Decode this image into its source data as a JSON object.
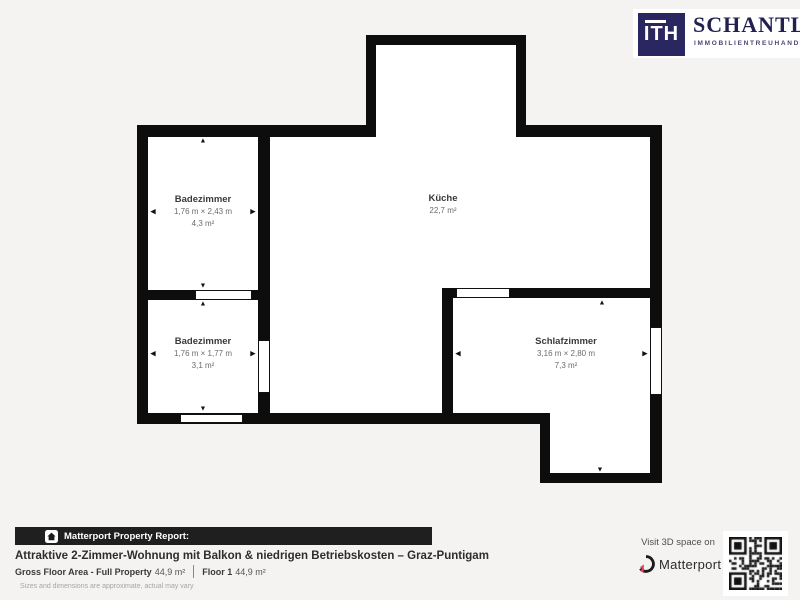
{
  "logo": {
    "monogram": "ITH",
    "brand": "SCHANTL",
    "tagline": "IMMOBILIENTREUHAND",
    "navy": "#2a265f"
  },
  "floor_plan": {
    "wall_color": "#0d0d0d",
    "rooms": [
      {
        "id": "badezimmer-1",
        "name": "Badezimmer",
        "dims": "1,76 m × 2,43 m",
        "area": "4,3 m²"
      },
      {
        "id": "badezimmer-2",
        "name": "Badezimmer",
        "dims": "1,76 m × 1,77 m",
        "area": "3,1 m²"
      },
      {
        "id": "kueche",
        "name": "Küche",
        "dims": "",
        "area": "22,7 m²"
      },
      {
        "id": "schlafzimmer",
        "name": "Schlafzimmer",
        "dims": "3,16 m × 2,80 m",
        "area": "7,3 m²"
      }
    ]
  },
  "report": {
    "bar_label": "Matterport Property Report:",
    "title": "Attraktive 2-Zimmer-Wohnung mit Balkon & niedrigen Betriebskosten – Graz-Puntigam",
    "gross_label": "Gross Floor Area - Full Property",
    "gross_value": "44,9 m²",
    "floor_label": "Floor 1",
    "floor_value": "44,9 m²",
    "disclaimer": "Sizes and dimensions are approximate, actual may vary"
  },
  "matterport": {
    "visit_text": "Visit 3D space on",
    "brand": "Matterport",
    "accent": "#e54360"
  }
}
